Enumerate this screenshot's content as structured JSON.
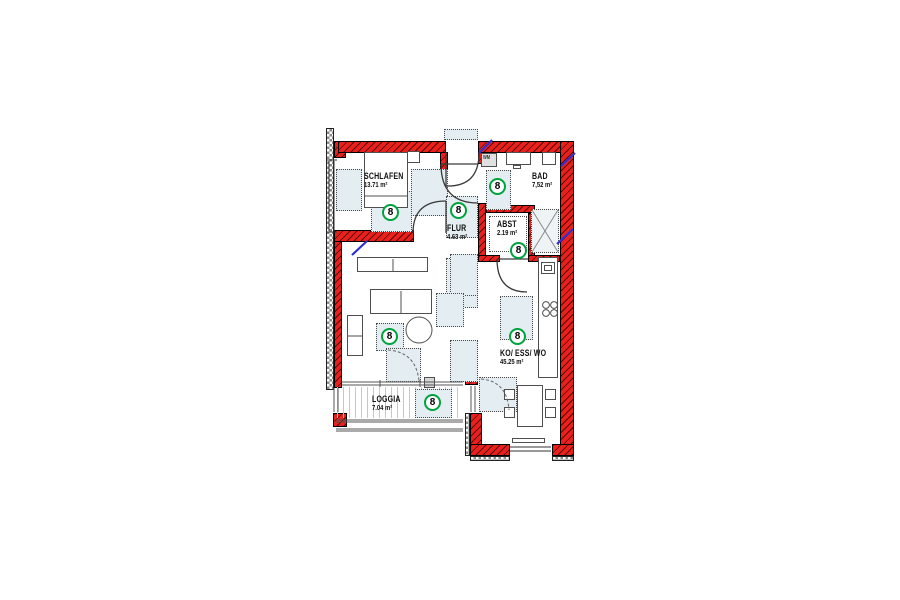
{
  "floor_plan": {
    "marker_label": "8",
    "rooms": [
      {
        "name": "SCHLAFEN",
        "area": "13.71 m²"
      },
      {
        "name": "BAD",
        "area": "7,52 m²"
      },
      {
        "name": "FLUR",
        "area": "4.63 m²"
      },
      {
        "name": "ABST",
        "area": "2.19 m²"
      },
      {
        "name": "KO/ ESS/ WO",
        "area": "45.25 m²"
      },
      {
        "name": "LOGGIA",
        "area": "7.04 m²"
      }
    ],
    "appliances": {
      "washing_machine": "WM"
    },
    "colors": {
      "new_wall": "#e8211d",
      "existing_wall": "#8a8a8a",
      "marker_green": "#00a33e",
      "lintel_blue": "#2f2fd3",
      "placeholder_fill": "#e4edf2"
    }
  }
}
